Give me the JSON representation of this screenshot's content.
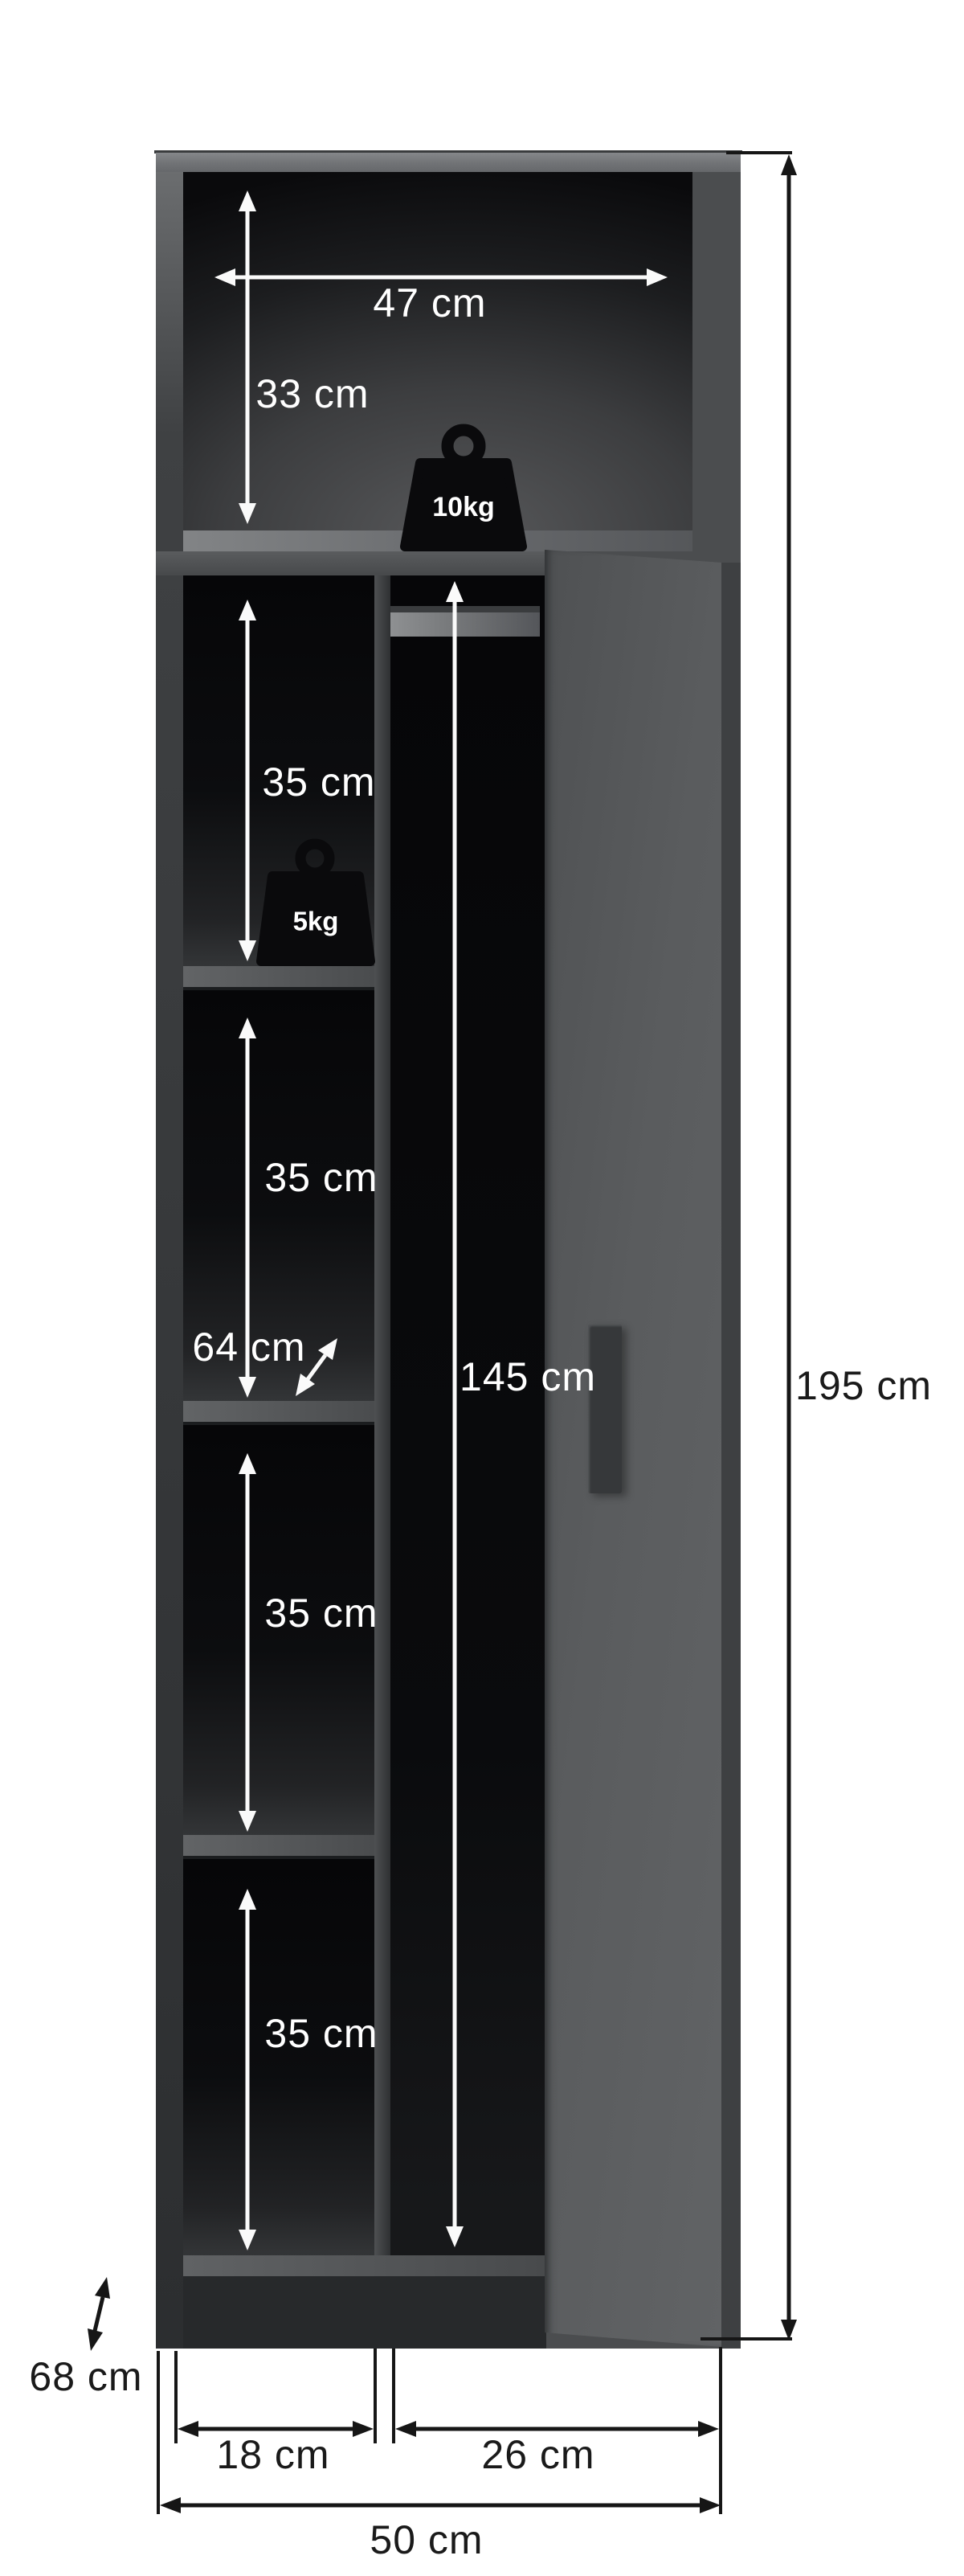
{
  "page": {
    "kind": "wardrobe dimension diagram",
    "unit": "cm"
  },
  "colors": {
    "cabinet_gray": "#5a5c5e",
    "interior_black": "#0b0b0d",
    "annotation_white": "#ffffff",
    "annotation_black": "#1a1a1a",
    "weight_icon": "#0a0a0c"
  },
  "dimensions": {
    "overall": {
      "height": "195 cm",
      "width": "50 cm",
      "depth": "68 cm"
    },
    "top_compartment": {
      "width": "47 cm",
      "height": "33 cm",
      "max_load": "10kg"
    },
    "shelf_column": {
      "section_heights": [
        "35 cm",
        "35 cm",
        "35 cm",
        "35 cm"
      ],
      "max_load": "5kg",
      "inner_depth": "64 cm",
      "inner_width": "18 cm"
    },
    "hanging_section": {
      "height": "145 cm",
      "inner_width": "26 cm"
    }
  }
}
